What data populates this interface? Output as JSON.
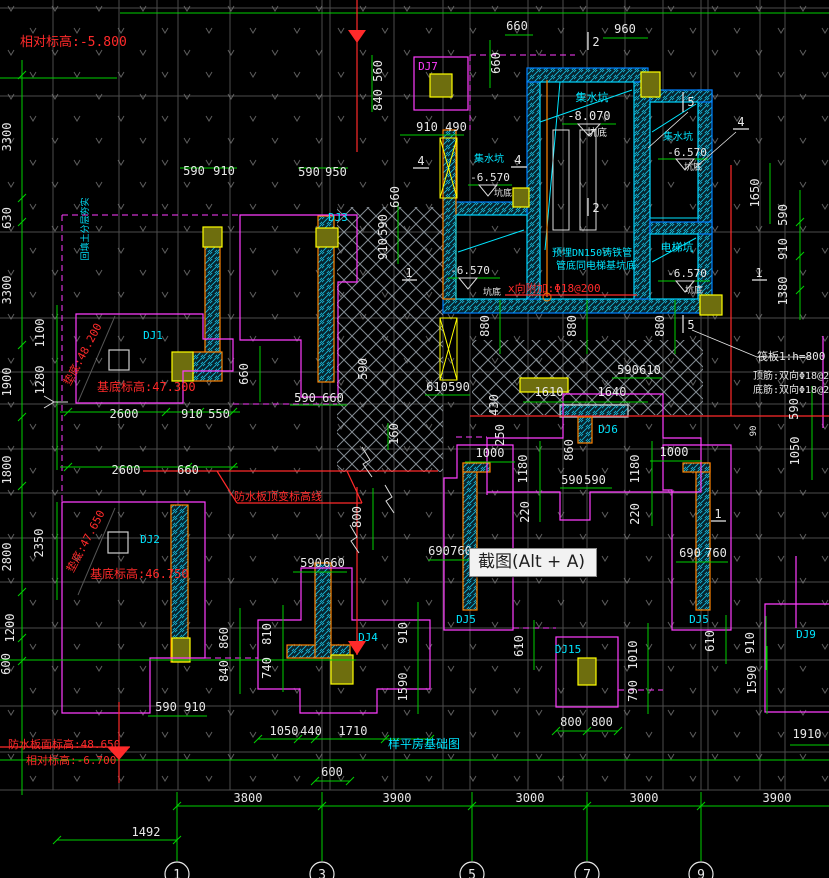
{
  "tooltip": {
    "text": "截图(Alt + A)"
  },
  "colors": {
    "w": "#e8e8e8",
    "r": "#ff2a2a",
    "c": "#00e5ff",
    "m": "#ff3cff",
    "g": "#00d000"
  },
  "axis_bubbles": [
    {
      "label": "1",
      "x": 177
    },
    {
      "label": "3",
      "x": 322
    },
    {
      "label": "5",
      "x": 472
    },
    {
      "label": "7",
      "x": 587
    },
    {
      "label": "9",
      "x": 701
    }
  ],
  "labels": [
    {
      "t": "相对标高:-5.800",
      "x": 20,
      "y": 46,
      "c": "r",
      "s": 13,
      "a": "s",
      "n": "elevation-note"
    },
    {
      "t": "垫底:48.200",
      "x": 86,
      "y": 356,
      "c": "r",
      "s": 11,
      "r": -62,
      "n": "elevation-note"
    },
    {
      "t": "基底标高:47.300",
      "x": 97,
      "y": 391,
      "c": "r",
      "s": 12,
      "a": "s",
      "n": "elevation-note"
    },
    {
      "t": "垫底:47.650",
      "x": 89,
      "y": 543,
      "c": "r",
      "s": 11,
      "r": -62,
      "n": "elevation-note"
    },
    {
      "t": "基底标高:46.750",
      "x": 90,
      "y": 578,
      "c": "r",
      "s": 12,
      "a": "s",
      "n": "elevation-note"
    },
    {
      "t": "防水板顶变标高线",
      "x": 234,
      "y": 500,
      "c": "r",
      "s": 11,
      "a": "s",
      "n": "waterproof-note"
    },
    {
      "t": "防水板面标高:48.650",
      "x": 8,
      "y": 748,
      "c": "r",
      "s": 11,
      "a": "s",
      "n": "elevation-note"
    },
    {
      "t": "相对标高:-6.700",
      "x": 26,
      "y": 764,
      "c": "r",
      "s": 11,
      "a": "s",
      "n": "elevation-note"
    },
    {
      "t": "x向附加:Φ18@200",
      "x": 508,
      "y": 292,
      "c": "r",
      "s": 11,
      "a": "s",
      "n": "rebar-note"
    },
    {
      "t": "筏板1:h=800",
      "x": 757,
      "y": 360,
      "c": "w",
      "s": 11,
      "a": "s",
      "n": "raft-note"
    },
    {
      "t": "顶筋:双向Φ18@200",
      "x": 753,
      "y": 379,
      "c": "w",
      "s": 10,
      "a": "s",
      "n": "rebar-note"
    },
    {
      "t": "底筋:双向Φ18@200",
      "x": 753,
      "y": 393,
      "c": "w",
      "s": 10,
      "a": "s",
      "n": "rebar-note"
    },
    {
      "t": "预埋DN150铸铁管",
      "x": 552,
      "y": 256,
      "c": "c",
      "s": 10,
      "a": "s",
      "n": "pipe-note"
    },
    {
      "t": "管底同电梯基坑底",
      "x": 556,
      "y": 269,
      "c": "c",
      "s": 10,
      "a": "s",
      "n": "pipe-note"
    },
    {
      "t": "回填土分层夯实",
      "x": 88,
      "y": 229,
      "c": "c",
      "s": 9,
      "r": -90,
      "n": "fill-note"
    },
    {
      "t": "样平房基础图",
      "x": 424,
      "y": 748,
      "c": "c",
      "s": 12,
      "n": "drawing-title"
    },
    {
      "t": "集水坑",
      "x": 592,
      "y": 101,
      "c": "c",
      "s": 11,
      "n": "pit-label"
    },
    {
      "t": "-8.070",
      "x": 589,
      "y": 120,
      "c": "w",
      "s": 12,
      "n": "pit-elevation"
    },
    {
      "t": "坑底",
      "x": 597,
      "y": 136,
      "c": "w",
      "s": 10,
      "n": "pit-label"
    },
    {
      "t": "集水坑",
      "x": 489,
      "y": 162,
      "c": "c",
      "s": 10,
      "n": "pit-label"
    },
    {
      "t": "-6.570",
      "x": 490,
      "y": 181,
      "c": "w",
      "s": 11,
      "n": "pit-elevation"
    },
    {
      "t": "坑底",
      "x": 503,
      "y": 196,
      "c": "w",
      "s": 9,
      "n": "pit-label"
    },
    {
      "t": "集水坑",
      "x": 678,
      "y": 140,
      "c": "c",
      "s": 10,
      "n": "pit-label"
    },
    {
      "t": "-6.570",
      "x": 687,
      "y": 156,
      "c": "w",
      "s": 11,
      "n": "pit-elevation"
    },
    {
      "t": "坑底",
      "x": 693,
      "y": 170,
      "c": "w",
      "s": 9,
      "n": "pit-label"
    },
    {
      "t": "电梯坑",
      "x": 677,
      "y": 251,
      "c": "c",
      "s": 11,
      "n": "pit-label"
    },
    {
      "t": "-6.570",
      "x": 687,
      "y": 277,
      "c": "w",
      "s": 11,
      "n": "pit-elevation"
    },
    {
      "t": "坑底",
      "x": 694,
      "y": 293,
      "c": "w",
      "s": 9,
      "n": "pit-label"
    },
    {
      "t": "-6.570",
      "x": 470,
      "y": 274,
      "c": "w",
      "s": 11,
      "n": "pit-elevation"
    },
    {
      "t": "坑底",
      "x": 492,
      "y": 295,
      "c": "w",
      "s": 9,
      "n": "pit-label"
    },
    {
      "t": "DJ7",
      "x": 428,
      "y": 70,
      "c": "m",
      "s": 11,
      "n": "footing-label"
    },
    {
      "t": "DJ3",
      "x": 338,
      "y": 221,
      "c": "c",
      "s": 11,
      "n": "footing-label"
    },
    {
      "t": "DJ1",
      "x": 153,
      "y": 339,
      "c": "c",
      "s": 11,
      "n": "footing-label"
    },
    {
      "t": "DJ2",
      "x": 150,
      "y": 543,
      "c": "c",
      "s": 11,
      "n": "footing-label"
    },
    {
      "t": "DJ4",
      "x": 368,
      "y": 641,
      "c": "c",
      "s": 11,
      "n": "footing-label"
    },
    {
      "t": "DJ5",
      "x": 466,
      "y": 623,
      "c": "c",
      "s": 11,
      "n": "footing-label"
    },
    {
      "t": "DJ5",
      "x": 699,
      "y": 623,
      "c": "c",
      "s": 11,
      "n": "footing-label"
    },
    {
      "t": "DJ15",
      "x": 568,
      "y": 653,
      "c": "c",
      "s": 11,
      "n": "footing-label"
    },
    {
      "t": "DJ6",
      "x": 608,
      "y": 433,
      "c": "c",
      "s": 11,
      "n": "footing-label"
    },
    {
      "t": "DJ9",
      "x": 806,
      "y": 638,
      "c": "c",
      "s": 11,
      "n": "footing-label"
    },
    {
      "t": "2",
      "x": 596,
      "y": 46,
      "c": "w",
      "s": 12,
      "n": "section-marker"
    },
    {
      "t": "2",
      "x": 596,
      "y": 212,
      "c": "w",
      "s": 12,
      "n": "section-marker"
    },
    {
      "t": "5",
      "x": 691,
      "y": 106,
      "c": "w",
      "s": 12,
      "n": "section-marker"
    },
    {
      "t": "5",
      "x": 691,
      "y": 329,
      "c": "w",
      "s": 12,
      "n": "section-marker"
    },
    {
      "t": "4",
      "x": 421,
      "y": 165,
      "c": "w",
      "s": 12,
      "n": "section-marker"
    },
    {
      "t": "4",
      "x": 518,
      "y": 164,
      "c": "w",
      "s": 12,
      "n": "section-marker"
    },
    {
      "t": "4",
      "x": 741,
      "y": 126,
      "c": "w",
      "s": 12,
      "n": "section-marker"
    },
    {
      "t": "1",
      "x": 409,
      "y": 277,
      "c": "w",
      "s": 12,
      "n": "section-marker"
    },
    {
      "t": "1",
      "x": 759,
      "y": 277,
      "c": "w",
      "s": 12,
      "n": "section-marker"
    },
    {
      "t": "1",
      "x": 718,
      "y": 518,
      "c": "w",
      "s": 12,
      "n": "section-marker"
    },
    {
      "t": "660",
      "x": 517,
      "y": 30
    },
    {
      "t": "960",
      "x": 625,
      "y": 33
    },
    {
      "t": "560",
      "x": 382,
      "y": 71,
      "v": 1
    },
    {
      "t": "840",
      "x": 382,
      "y": 100,
      "v": 1
    },
    {
      "t": "910",
      "x": 427,
      "y": 131
    },
    {
      "t": "490",
      "x": 456,
      "y": 131
    },
    {
      "t": "660",
      "x": 500,
      "y": 63,
      "v": 1
    },
    {
      "t": "590",
      "x": 194,
      "y": 175
    },
    {
      "t": "910",
      "x": 224,
      "y": 175
    },
    {
      "t": "590",
      "x": 309,
      "y": 176
    },
    {
      "t": "950",
      "x": 336,
      "y": 176
    },
    {
      "t": "660",
      "x": 399,
      "y": 197,
      "v": 1
    },
    {
      "t": "590",
      "x": 387,
      "y": 225,
      "v": 1
    },
    {
      "t": "910",
      "x": 387,
      "y": 249,
      "v": 1
    },
    {
      "t": "1650",
      "x": 759,
      "y": 193,
      "v": 1
    },
    {
      "t": "590",
      "x": 787,
      "y": 215,
      "v": 1
    },
    {
      "t": "910",
      "x": 787,
      "y": 249,
      "v": 1
    },
    {
      "t": "1380",
      "x": 787,
      "y": 291,
      "v": 1
    },
    {
      "t": "880",
      "x": 489,
      "y": 326,
      "v": 1
    },
    {
      "t": "880",
      "x": 576,
      "y": 326,
      "v": 1
    },
    {
      "t": "880",
      "x": 664,
      "y": 326,
      "v": 1
    },
    {
      "t": "590",
      "x": 628,
      "y": 374
    },
    {
      "t": "610",
      "x": 650,
      "y": 374
    },
    {
      "t": "610",
      "x": 437,
      "y": 391
    },
    {
      "t": "590",
      "x": 459,
      "y": 391
    },
    {
      "t": "1610",
      "x": 549,
      "y": 396
    },
    {
      "t": "1640",
      "x": 612,
      "y": 396
    },
    {
      "t": "590",
      "x": 367,
      "y": 369,
      "v": 1
    },
    {
      "t": "660",
      "x": 248,
      "y": 374,
      "v": 1
    },
    {
      "t": "2600",
      "x": 124,
      "y": 418
    },
    {
      "t": "910",
      "x": 192,
      "y": 418
    },
    {
      "t": "550",
      "x": 219,
      "y": 418
    },
    {
      "t": "2600",
      "x": 126,
      "y": 474
    },
    {
      "t": "660",
      "x": 188,
      "y": 474
    },
    {
      "t": "590",
      "x": 305,
      "y": 402
    },
    {
      "t": "660",
      "x": 333,
      "y": 402
    },
    {
      "t": "160",
      "x": 398,
      "y": 434,
      "v": 1
    },
    {
      "t": "800",
      "x": 361,
      "y": 517,
      "v": 1
    },
    {
      "t": "430",
      "x": 498,
      "y": 405,
      "v": 1
    },
    {
      "t": "250",
      "x": 504,
      "y": 435,
      "v": 1
    },
    {
      "t": "860",
      "x": 573,
      "y": 450,
      "v": 1
    },
    {
      "t": "1000",
      "x": 490,
      "y": 457
    },
    {
      "t": "1000",
      "x": 674,
      "y": 456
    },
    {
      "t": "1180",
      "x": 527,
      "y": 469,
      "v": 1
    },
    {
      "t": "1180",
      "x": 639,
      "y": 469,
      "v": 1
    },
    {
      "t": "220",
      "x": 529,
      "y": 512,
      "v": 1
    },
    {
      "t": "220",
      "x": 639,
      "y": 514,
      "v": 1
    },
    {
      "t": "590",
      "x": 572,
      "y": 484
    },
    {
      "t": "590",
      "x": 595,
      "y": 484
    },
    {
      "t": "90",
      "x": 756,
      "y": 431,
      "v": 1,
      "s": 9
    },
    {
      "t": "590",
      "x": 798,
      "y": 409,
      "v": 1
    },
    {
      "t": "1050",
      "x": 799,
      "y": 451,
      "v": 1
    },
    {
      "t": "690",
      "x": 439,
      "y": 555
    },
    {
      "t": "760",
      "x": 461,
      "y": 555
    },
    {
      "t": "690",
      "x": 690,
      "y": 557
    },
    {
      "t": "760",
      "x": 716,
      "y": 557
    },
    {
      "t": "860",
      "x": 228,
      "y": 638,
      "v": 1
    },
    {
      "t": "840",
      "x": 228,
      "y": 671,
      "v": 1
    },
    {
      "t": "810",
      "x": 271,
      "y": 634,
      "v": 1
    },
    {
      "t": "740",
      "x": 271,
      "y": 668,
      "v": 1
    },
    {
      "t": "590",
      "x": 166,
      "y": 711
    },
    {
      "t": "910",
      "x": 195,
      "y": 711
    },
    {
      "t": "590",
      "x": 311,
      "y": 567
    },
    {
      "t": "660",
      "x": 334,
      "y": 567
    },
    {
      "t": "910",
      "x": 407,
      "y": 633,
      "v": 1
    },
    {
      "t": "1590",
      "x": 407,
      "y": 687,
      "v": 1
    },
    {
      "t": "1590",
      "x": 756,
      "y": 680,
      "v": 1
    },
    {
      "t": "610",
      "x": 523,
      "y": 646,
      "v": 1
    },
    {
      "t": "610",
      "x": 714,
      "y": 641,
      "v": 1
    },
    {
      "t": "910",
      "x": 754,
      "y": 643,
      "v": 1
    },
    {
      "t": "1010",
      "x": 637,
      "y": 655,
      "v": 1
    },
    {
      "t": "790",
      "x": 637,
      "y": 691,
      "v": 1
    },
    {
      "t": "800",
      "x": 571,
      "y": 726
    },
    {
      "t": "800",
      "x": 602,
      "y": 726
    },
    {
      "t": "1050",
      "x": 284,
      "y": 735
    },
    {
      "t": "440",
      "x": 311,
      "y": 735
    },
    {
      "t": "1710",
      "x": 353,
      "y": 735
    },
    {
      "t": "600",
      "x": 332,
      "y": 776
    },
    {
      "t": "3800",
      "x": 248,
      "y": 802
    },
    {
      "t": "3900",
      "x": 397,
      "y": 802
    },
    {
      "t": "3000",
      "x": 530,
      "y": 802
    },
    {
      "t": "3000",
      "x": 644,
      "y": 802
    },
    {
      "t": "3900",
      "x": 777,
      "y": 802
    },
    {
      "t": "1492",
      "x": 146,
      "y": 836
    },
    {
      "t": "1910",
      "x": 807,
      "y": 738
    },
    {
      "t": "3300",
      "x": 11,
      "y": 137,
      "v": 1
    },
    {
      "t": "630",
      "x": 11,
      "y": 218,
      "v": 1
    },
    {
      "t": "3300",
      "x": 11,
      "y": 290,
      "v": 1
    },
    {
      "t": "1900",
      "x": 11,
      "y": 382,
      "v": 1
    },
    {
      "t": "1800",
      "x": 11,
      "y": 470,
      "v": 1
    },
    {
      "t": "2800",
      "x": 11,
      "y": 557,
      "v": 1
    },
    {
      "t": "1200",
      "x": 14,
      "y": 628,
      "v": 1
    },
    {
      "t": "600",
      "x": 10,
      "y": 664,
      "v": 1
    },
    {
      "t": "1100",
      "x": 44,
      "y": 333,
      "v": 1
    },
    {
      "t": "1280",
      "x": 44,
      "y": 380,
      "v": 1
    },
    {
      "t": "2350",
      "x": 43,
      "y": 543,
      "v": 1
    }
  ]
}
